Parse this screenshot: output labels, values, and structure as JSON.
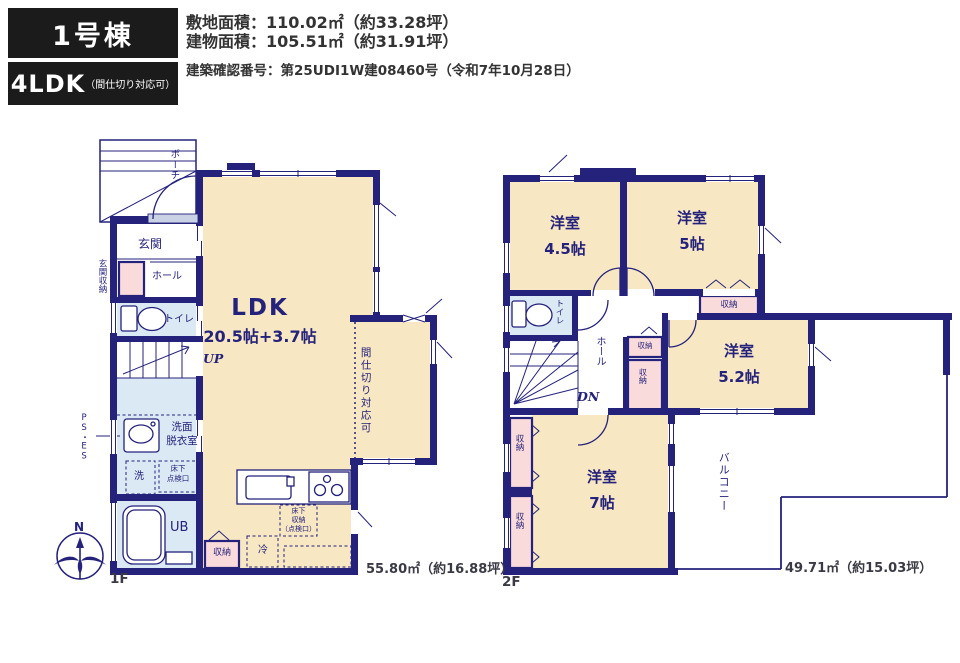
{
  "header": {
    "building": "1号棟",
    "layout": "4LDK",
    "layout_note": "（間仕切り対応可）",
    "site_area": "敷地面積：110.02㎡（約33.28坪）",
    "building_area": "建物面積：105.51㎡（約31.91坪）",
    "confirmation_number": "建築確認番号：第25UDI1W建08460号（令和7年10月28日）"
  },
  "compass": {
    "north": "N"
  },
  "floor1": {
    "name": "1F",
    "area": "55.80㎡（約16.88坪）",
    "labels": {
      "porch": "ポーチ",
      "entrance": "玄関",
      "entrance_storage": "玄関収納",
      "hall": "ホール",
      "toilet": "トイレ",
      "up": "UP",
      "ldk": "LDK",
      "ldk_size": "20.5帖+3.7帖",
      "partition_note": "間仕切り対応可",
      "ps_es": "PS・ES",
      "washroom": "洗面\n脱衣室",
      "washer": "洗",
      "underfloor_hatch": "床下\n点検口",
      "bath": "UB",
      "storage": "収納",
      "fridge": "冷",
      "floor_storage": "床下\n収納\n（点検口）"
    }
  },
  "floor2": {
    "name": "2F",
    "area": "49.71㎡（約15.03坪）",
    "labels": {
      "room45": "洋室\n4.5帖",
      "room5": "洋室\n5帖",
      "room52": "洋室\n5.2帖",
      "room7": "洋室\n7帖",
      "toilet": "トイレ",
      "hall": "ホール",
      "dn": "DN",
      "storage": "収納",
      "balcony": "バルコニー"
    }
  },
  "colors": {
    "wall_navy": "#24227b",
    "room_cream": "#f7e7c3",
    "wet_blue": "#dbe9f4",
    "storage_pink": "#f9dbdb",
    "badge_black": "#1b1b1b"
  }
}
